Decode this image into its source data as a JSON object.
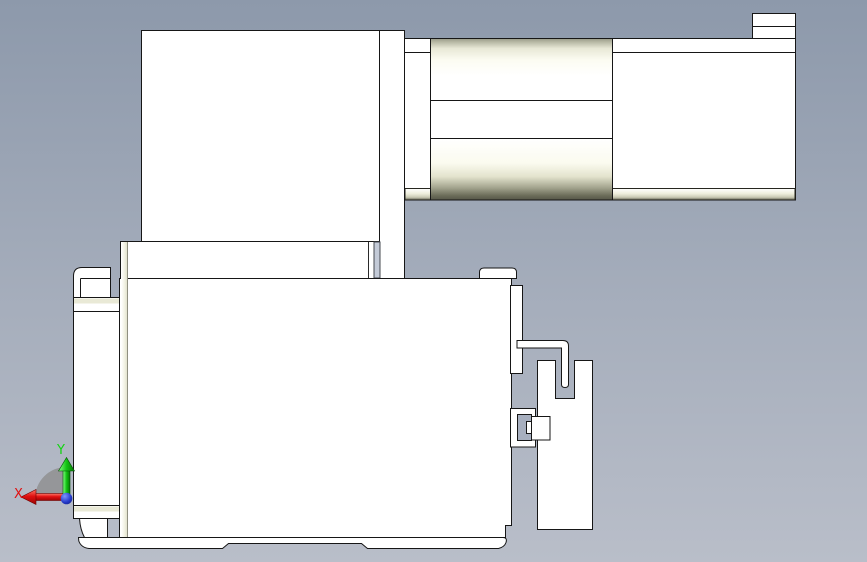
{
  "scene": {
    "type": "cad-orthographic-side-view",
    "description": "Side view of a motorized linear actuator stage with folded motor",
    "background_top": "#8d99ab",
    "background_mid": "#a6aebc",
    "background_bottom": "#b9bec9",
    "outline_color": "#161616",
    "part_fill": "#ffffff",
    "shade_cream": "#efefdd",
    "shade_olive_dark": "#565748",
    "shade_steel_blue": "#c3cad7",
    "parts": [
      "motor-block",
      "motor-mount-plate",
      "motor-flange-plate",
      "actuator-rail",
      "rail-end-tab",
      "coupling-cylinder-upper",
      "coupling-cylinder-lower",
      "carriage-body",
      "side-plate-left",
      "clamp-tab-top-left",
      "clamp-tab-bottom-left",
      "base-plate",
      "slider-tab-top-right",
      "sensor-rail-strip",
      "cable-hook",
      "sensor-dog-block",
      "sensor-clip"
    ]
  },
  "axis_triad": {
    "x_label": "X",
    "y_label": "Y",
    "x_color": "#e01010",
    "y_color": "#12d412",
    "origin_color": "#2438c8",
    "arc_color": "#8d8d8d"
  }
}
